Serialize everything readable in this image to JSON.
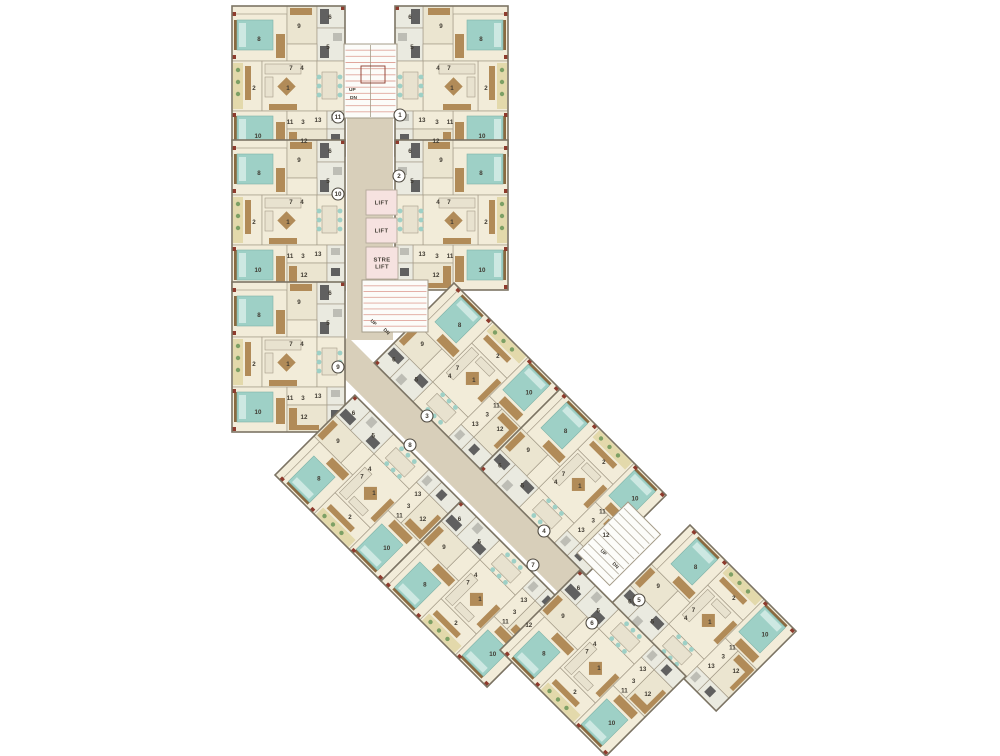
{
  "canvas": {
    "width": 1000,
    "height": 756
  },
  "colors": {
    "background": "#ffffff",
    "floor": "#f2ecd9",
    "floor2": "#ebe5d0",
    "bath": "#eaeae0",
    "balc": "#e3d9ab",
    "corridor": "#d8cfba",
    "wall": "#7c7464",
    "wallIn": "#a59c89",
    "teal": "#9ed0c6",
    "tealLight": "#cde8e2",
    "tealDark": "#7fb3a8",
    "brown": "#b18b58",
    "brownDark": "#8a6a40",
    "sofa": "#e8e2cf",
    "grayDark": "#606060",
    "grayLight": "#bdbdb5",
    "red": "#8e3b2d",
    "plant": "#7da065",
    "liftFill": "#f6e2e0",
    "liftStroke": "#b3a99b",
    "stairFill": "#fcfcf9",
    "stairHatchRed": "#e0a69c",
    "stairHatchGray": "#b9b3a5",
    "label": "#3f3a31",
    "circleStroke": "#4f4a40"
  },
  "prototype": {
    "width": 113,
    "height": 150,
    "rooms": [
      {
        "name": "bedroom-a",
        "x": 0,
        "y": 8,
        "w": 55,
        "h": 47,
        "f": "floor"
      },
      {
        "name": "dress",
        "x": 55,
        "y": 0,
        "w": 30,
        "h": 38,
        "f": "floor2"
      },
      {
        "name": "toilet-a",
        "x": 85,
        "y": 0,
        "w": 28,
        "h": 22,
        "f": "bath"
      },
      {
        "name": "bath-a",
        "x": 85,
        "y": 22,
        "w": 28,
        "h": 33,
        "f": "bath"
      },
      {
        "name": "hall-passage",
        "x": 55,
        "y": 38,
        "w": 30,
        "h": 17,
        "f": "floor"
      },
      {
        "name": "sitout",
        "x": 0,
        "y": 55,
        "w": 30,
        "h": 50,
        "f": "floor"
      },
      {
        "name": "living",
        "x": 30,
        "y": 55,
        "w": 55,
        "h": 50,
        "f": "floor"
      },
      {
        "name": "dining",
        "x": 85,
        "y": 55,
        "w": 28,
        "h": 50,
        "f": "floor"
      },
      {
        "name": "bedroom-b",
        "x": 0,
        "y": 105,
        "w": 55,
        "h": 45,
        "f": "floor"
      },
      {
        "name": "passage",
        "x": 55,
        "y": 105,
        "w": 40,
        "h": 18,
        "f": "floor"
      },
      {
        "name": "toilet-b",
        "x": 95,
        "y": 105,
        "w": 18,
        "h": 18,
        "f": "bath"
      },
      {
        "name": "kitchen",
        "x": 55,
        "y": 123,
        "w": 40,
        "h": 27,
        "f": "floor2"
      },
      {
        "name": "utility",
        "x": 95,
        "y": 123,
        "w": 18,
        "h": 27,
        "f": "bath"
      }
    ],
    "furniture": [
      {
        "name": "headboard",
        "k": "rect",
        "x": 2,
        "y": 14,
        "w": 3,
        "h": 30,
        "f": "brownDark"
      },
      {
        "name": "bed",
        "k": "rect",
        "x": 5,
        "y": 14,
        "w": 36,
        "h": 30,
        "f": "teal",
        "s": "tealDark"
      },
      {
        "name": "pillows",
        "k": "rect",
        "x": 7,
        "y": 17,
        "w": 7,
        "h": 24,
        "f": "tealLight"
      },
      {
        "name": "wardrobe",
        "k": "rect",
        "x": 44,
        "y": 28,
        "w": 9,
        "h": 24,
        "f": "brown"
      },
      {
        "name": "wardrobe",
        "k": "rect",
        "x": 58,
        "y": 2,
        "w": 22,
        "h": 7,
        "f": "brown"
      },
      {
        "name": "bath-fixture",
        "k": "rect",
        "x": 88,
        "y": 3,
        "w": 9,
        "h": 15,
        "f": "grayDark"
      },
      {
        "name": "basin",
        "k": "rect",
        "x": 101,
        "y": 27,
        "w": 9,
        "h": 8,
        "f": "grayLight"
      },
      {
        "name": "shower",
        "k": "rect",
        "x": 88,
        "y": 40,
        "w": 9,
        "h": 12,
        "f": "grayDark"
      },
      {
        "name": "deck",
        "k": "rect",
        "x": 1,
        "y": 57,
        "w": 10,
        "h": 46,
        "f": "balc"
      },
      {
        "name": "plant",
        "k": "circ",
        "x": 6,
        "y": 64,
        "r": 2.2,
        "f": "plant"
      },
      {
        "name": "plant",
        "k": "circ",
        "x": 6,
        "y": 76,
        "r": 2.2,
        "f": "plant"
      },
      {
        "name": "plant",
        "k": "circ",
        "x": 6,
        "y": 88,
        "r": 2.2,
        "f": "plant"
      },
      {
        "name": "bench",
        "k": "rect",
        "x": 13,
        "y": 60,
        "w": 6,
        "h": 34,
        "f": "brown"
      },
      {
        "name": "sofa",
        "k": "rect",
        "x": 33,
        "y": 58,
        "w": 36,
        "h": 10,
        "f": "sofa",
        "s": "wallIn"
      },
      {
        "name": "sofa",
        "k": "rect",
        "x": 33,
        "y": 71,
        "w": 8,
        "h": 20,
        "f": "sofa",
        "s": "wallIn"
      },
      {
        "name": "coffee-table",
        "k": "rect",
        "x": 48,
        "y": 74,
        "w": 13,
        "h": 13,
        "f": "brown",
        "rot": 45
      },
      {
        "name": "tv-unit",
        "k": "rect",
        "x": 37,
        "y": 98,
        "w": 28,
        "h": 6,
        "f": "brown"
      },
      {
        "name": "dining-table",
        "k": "rect",
        "x": 90,
        "y": 66,
        "w": 15,
        "h": 27,
        "f": "sofa",
        "s": "wallIn"
      },
      {
        "name": "chair",
        "k": "circ",
        "x": 87,
        "y": 71,
        "r": 2.4,
        "f": "teal"
      },
      {
        "name": "chair",
        "k": "circ",
        "x": 87,
        "y": 80,
        "r": 2.4,
        "f": "teal"
      },
      {
        "name": "chair",
        "k": "circ",
        "x": 87,
        "y": 89,
        "r": 2.4,
        "f": "teal"
      },
      {
        "name": "chair",
        "k": "circ",
        "x": 108,
        "y": 71,
        "r": 2.4,
        "f": "teal"
      },
      {
        "name": "chair",
        "k": "circ",
        "x": 108,
        "y": 80,
        "r": 2.4,
        "f": "teal"
      },
      {
        "name": "chair",
        "k": "circ",
        "x": 108,
        "y": 89,
        "r": 2.4,
        "f": "teal"
      },
      {
        "name": "headboard",
        "k": "rect",
        "x": 2,
        "y": 110,
        "w": 3,
        "h": 30,
        "f": "brownDark"
      },
      {
        "name": "bed",
        "k": "rect",
        "x": 5,
        "y": 110,
        "w": 36,
        "h": 30,
        "f": "teal",
        "s": "tealDark"
      },
      {
        "name": "pillows",
        "k": "rect",
        "x": 7,
        "y": 113,
        "w": 7,
        "h": 24,
        "f": "tealLight"
      },
      {
        "name": "wardrobe",
        "k": "rect",
        "x": 44,
        "y": 116,
        "w": 9,
        "h": 26,
        "f": "brown"
      },
      {
        "name": "kitchen-counter",
        "k": "rect",
        "x": 57,
        "y": 126,
        "w": 8,
        "h": 20,
        "f": "brown"
      },
      {
        "name": "kitchen-counter",
        "k": "rect",
        "x": 57,
        "y": 143,
        "w": 30,
        "h": 5,
        "f": "brown"
      },
      {
        "name": "wc",
        "k": "rect",
        "x": 99,
        "y": 108,
        "w": 9,
        "h": 7,
        "f": "grayLight"
      },
      {
        "name": "washer",
        "k": "rect",
        "x": 99,
        "y": 128,
        "w": 9,
        "h": 8,
        "f": "grayDark"
      },
      {
        "name": "geyser",
        "k": "rect",
        "x": 0,
        "y": 6,
        "w": 4,
        "h": 4,
        "f": "red"
      },
      {
        "name": "geyser",
        "k": "rect",
        "x": 0,
        "y": 49,
        "w": 4,
        "h": 4,
        "f": "red"
      },
      {
        "name": "geyser",
        "k": "rect",
        "x": 0,
        "y": 107,
        "w": 4,
        "h": 4,
        "f": "red"
      },
      {
        "name": "geyser",
        "k": "rect",
        "x": 0,
        "y": 145,
        "w": 4,
        "h": 4,
        "f": "red"
      },
      {
        "name": "geyser",
        "k": "rect",
        "x": 109,
        "y": 0,
        "w": 4,
        "h": 4,
        "f": "red"
      }
    ],
    "room_labels": [
      {
        "t": "8",
        "x": 27,
        "y": 35
      },
      {
        "t": "9",
        "x": 67,
        "y": 22
      },
      {
        "t": "6",
        "x": 98,
        "y": 13
      },
      {
        "t": "5",
        "x": 96,
        "y": 43
      },
      {
        "t": "7",
        "x": 59,
        "y": 64
      },
      {
        "t": "4",
        "x": 70,
        "y": 64
      },
      {
        "t": "2",
        "x": 22,
        "y": 84
      },
      {
        "t": "1",
        "x": 56,
        "y": 84
      },
      {
        "t": "11",
        "x": 58,
        "y": 118
      },
      {
        "t": "3",
        "x": 71,
        "y": 118
      },
      {
        "t": "13",
        "x": 86,
        "y": 116
      },
      {
        "t": "10",
        "x": 26,
        "y": 132
      },
      {
        "t": "12",
        "x": 72,
        "y": 137
      }
    ]
  },
  "units": [
    {
      "number": "11",
      "tx": 232,
      "ty": 6,
      "rot": 0,
      "mirror": false,
      "cx": 338,
      "cy": 117
    },
    {
      "number": "10",
      "tx": 232,
      "ty": 140,
      "rot": 0,
      "mirror": false,
      "cx": 338,
      "cy": 194
    },
    {
      "number": "9",
      "tx": 232,
      "ty": 282,
      "rot": 0,
      "mirror": false,
      "cx": 338,
      "cy": 367
    },
    {
      "number": "1",
      "tx": 508,
      "ty": 6,
      "rot": 0,
      "mirror": true,
      "cx": 400,
      "cy": 115
    },
    {
      "number": "2",
      "tx": 508,
      "ty": 140,
      "rot": 0,
      "mirror": true,
      "cx": 399,
      "cy": 176
    },
    {
      "number": "3",
      "tx": 454,
      "ty": 283,
      "rot": -45,
      "mirror": true,
      "cx": 427,
      "cy": 416
    },
    {
      "number": "4",
      "tx": 560,
      "ty": 389,
      "rot": -45,
      "mirror": true,
      "cx": 544,
      "cy": 531
    },
    {
      "number": "5",
      "tx": 690,
      "ty": 525,
      "rot": -45,
      "mirror": true,
      "cx": 639,
      "cy": 600
    },
    {
      "number": "8",
      "tx": 275,
      "ty": 475,
      "rot": -45,
      "mirror": false,
      "cx": 410,
      "cy": 445
    },
    {
      "number": "7",
      "tx": 381,
      "ty": 581,
      "rot": -45,
      "mirror": false,
      "cx": 533,
      "cy": 565
    },
    {
      "number": "6",
      "tx": 500,
      "ty": 650,
      "rot": -45,
      "mirror": false,
      "cx": 592,
      "cy": 623
    }
  ],
  "corridors": [
    {
      "x": 347,
      "y": 106,
      "w": 46,
      "h": 226,
      "rot": 0
    },
    {
      "x": 347,
      "y": 300,
      "w": 46,
      "h": 40,
      "rot": 0
    },
    {
      "x": 348,
      "y": 337,
      "w": 400,
      "h": 32,
      "rot": 45
    }
  ],
  "stairs": [
    {
      "x": 344,
      "y": 44,
      "w": 53,
      "h": 74,
      "rot": 0,
      "steps": 12,
      "hatch": "stairHatchRed",
      "divider": true,
      "redbox": {
        "x": 17,
        "y": 22,
        "w": 24,
        "h": 17
      },
      "labels": [
        {
          "t": "UP",
          "x": 349,
          "y": 91,
          "rot": 0
        },
        {
          "t": "DN",
          "x": 350,
          "y": 99,
          "rot": 0
        }
      ]
    },
    {
      "x": 362,
      "y": 280,
      "w": 66,
      "h": 52,
      "rot": 0,
      "steps": 9,
      "hatch": "stairHatchRed",
      "labels": [
        {
          "t": "UP",
          "x": 370,
          "y": 321,
          "rot": 45
        },
        {
          "t": "DN",
          "x": 383,
          "y": 330,
          "rot": 45
        }
      ]
    },
    {
      "x": 628,
      "y": 502,
      "w": 46,
      "h": 72,
      "rot": 45,
      "steps": 10,
      "hatch": "stairHatchGray",
      "labels": [
        {
          "t": "UP",
          "x": 600,
          "y": 551,
          "rot": 45
        },
        {
          "t": "DN",
          "x": 612,
          "y": 564,
          "rot": 45
        }
      ]
    }
  ],
  "lifts": [
    {
      "label": "LIFT",
      "x": 366,
      "y": 190,
      "w": 31,
      "h": 25
    },
    {
      "label": "LIFT",
      "x": 366,
      "y": 218,
      "w": 31,
      "h": 25
    },
    {
      "label": "STRE LIFT",
      "x": 366,
      "y": 247,
      "w": 32,
      "h": 32
    }
  ]
}
